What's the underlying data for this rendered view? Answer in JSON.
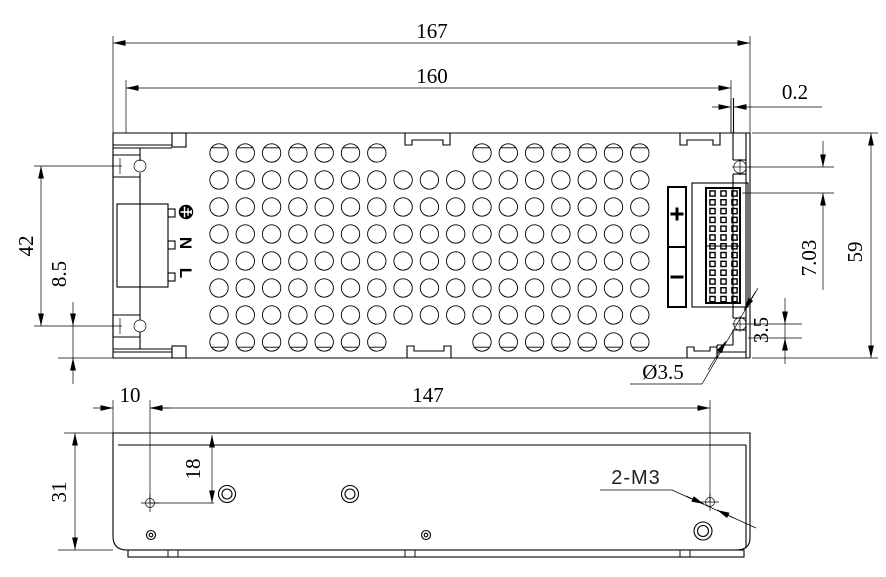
{
  "drawing": {
    "background_color": "#ffffff",
    "line_color": "#000000",
    "views": [
      "top-view",
      "side-view"
    ]
  },
  "top_view": {
    "dims": {
      "overall_width": "167",
      "cover_width": "160",
      "edge_offset": "0.2",
      "mount_hole_spacing": "42",
      "hole_to_bottom_left": "8.5",
      "overall_depth": "59",
      "hole_to_pin_row": "7.03",
      "hole_to_notch": "3.5",
      "mount_hole_diameter": "Ø3.5"
    },
    "labels": {
      "ground_icon": "earth-ground-icon",
      "neutral": "N",
      "line": "L",
      "positive": "+",
      "negative": "−"
    },
    "features": {
      "vent_hole_rows": 8,
      "vent_hole_cols": 17,
      "output_pin_cols": 3,
      "output_pin_rows": 13
    }
  },
  "side_view": {
    "dims": {
      "left_hole_offset": "10",
      "hole_spacing": "147",
      "hole_drop": "18",
      "overall_height": "31"
    },
    "thread_label": "2-M3"
  },
  "geometry": {
    "vents": {
      "cx0": 219,
      "dx": 26.3,
      "cols": 17,
      "cy0": 153,
      "dy": 27,
      "rows": 8,
      "r": 9.2,
      "edge_skip_cols": [
        7,
        8,
        9
      ],
      "chord": 5.2,
      "chord_half": 7.6
    },
    "pins": {
      "cx": [
        712.5,
        723.5,
        734.5
      ],
      "cy0": 193.5,
      "dy": 8.8,
      "rows": 13,
      "size": 5.2
    },
    "foot_ticks": [
      168,
      178,
      405,
      415,
      680,
      690
    ]
  }
}
